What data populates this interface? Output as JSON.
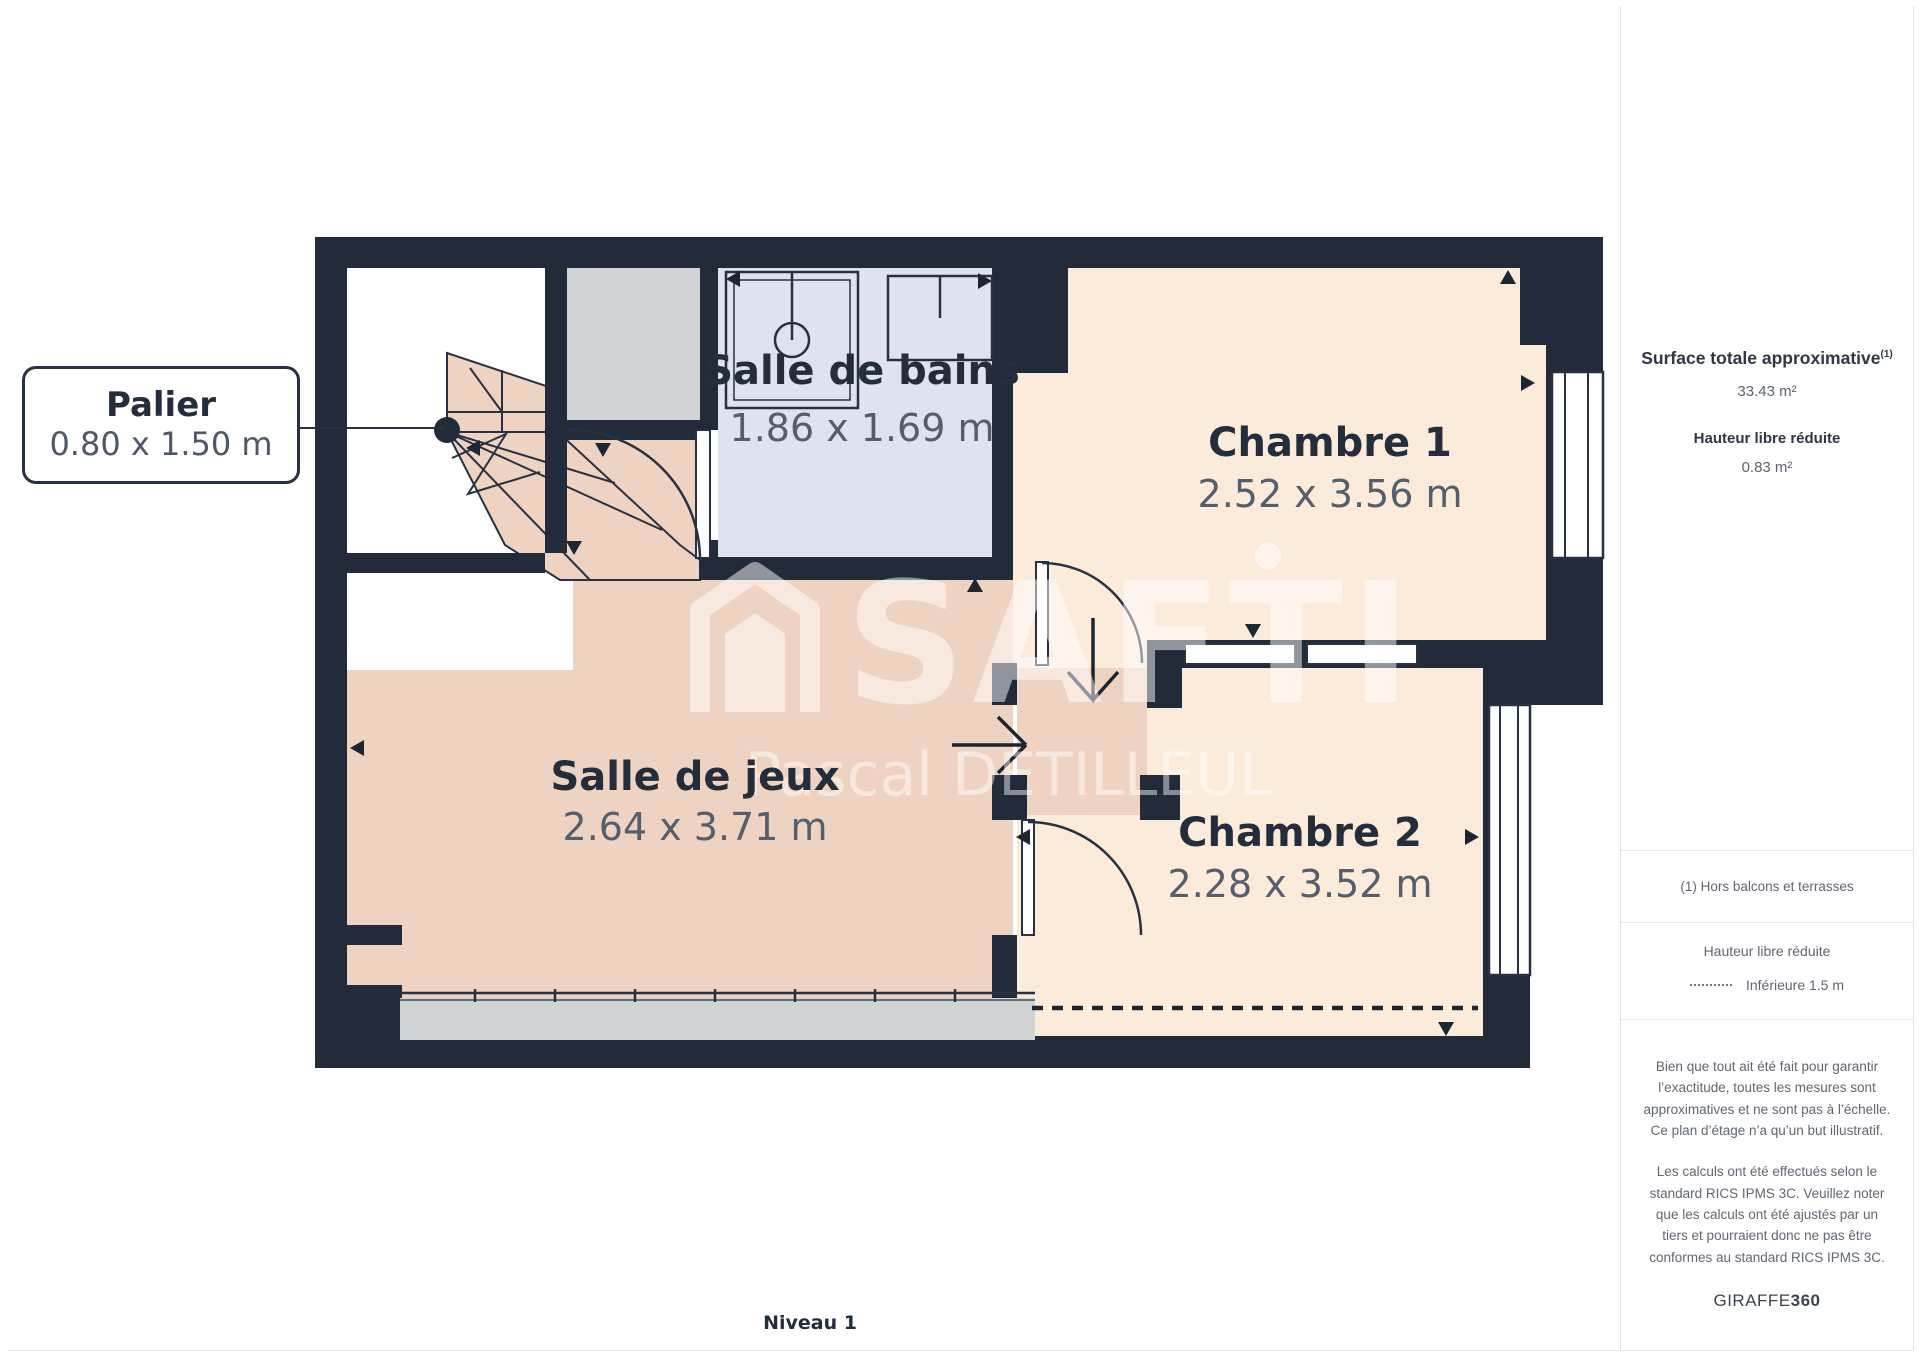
{
  "plan": {
    "level_label": "Niveau 1",
    "callout": {
      "name": "Palier",
      "dims": "0.80 x 1.50 m"
    },
    "rooms": {
      "bains": {
        "name": "Salle de bains",
        "dims": "1.86 x 1.69 m"
      },
      "ch1": {
        "name": "Chambre 1",
        "dims": "2.52 x 3.56 m"
      },
      "jeux": {
        "name": "Salle de jeux",
        "dims": "2.64 x 3.71 m"
      },
      "ch2": {
        "name": "Chambre 2",
        "dims": "2.28 x 3.52 m"
      }
    },
    "watermark": {
      "brand": "SAFTI",
      "agent": "Pascal DETILLEUL"
    },
    "colors": {
      "wall": "#212b3a",
      "cream": "#fbebdb",
      "rose": "#efd3c2",
      "blue": "#dee3ef",
      "gray": "#d2d3d4",
      "dims_text": "#545e6c",
      "name_text": "#232d3b"
    }
  },
  "sidebar": {
    "surface_title": "Surface totale approximative",
    "surface_sup": "(1)",
    "surface_value": "33.43 m²",
    "height_title": "Hauteur libre réduite",
    "height_value": "0.83 m²",
    "footnote": "(1) Hors balcons et terrasses",
    "legend_title": "Hauteur libre réduite",
    "legend_item": "Inférieure 1.5 m",
    "disclaimer_1": "Bien que tout ait été fait pour garantir l’exactitude, toutes les mesures sont approximatives et ne sont pas à l’échelle. Ce plan d’étage n’a qu’un but illustratif.",
    "disclaimer_2": "Les calculs ont été effectués selon le standard RICS IPMS 3C. Veuillez noter que les calculs ont été ajustés par un tiers et pourraient donc ne pas être conformes au standard RICS IPMS 3C.",
    "brand": "GIRAFFE",
    "brand_suffix": "360"
  }
}
